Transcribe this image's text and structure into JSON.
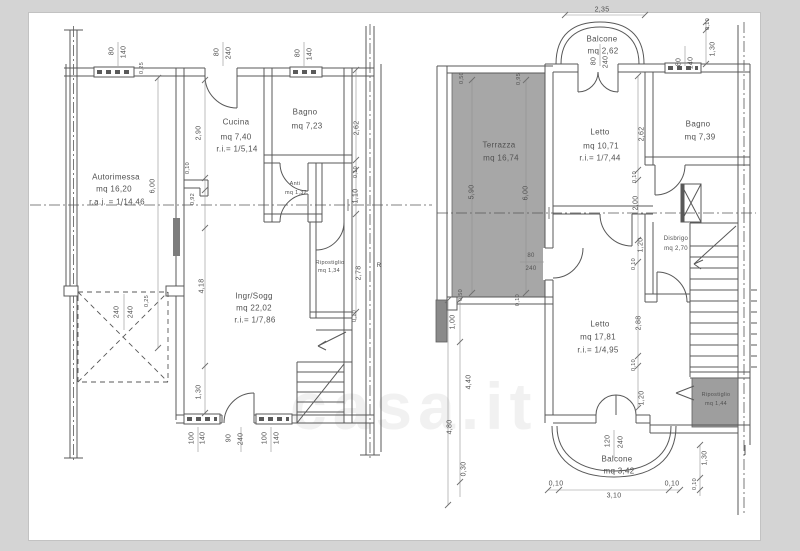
{
  "watermark": "casa.it",
  "ground": {
    "rooms": {
      "autorimessa": {
        "name": "Autorimessa",
        "area": "mq 16,20",
        "ratio": "r.a.i. = 1/14,46"
      },
      "cucina": {
        "name": "Cucina",
        "area": "mq 7,40",
        "ratio": "r.i.= 1/5,14"
      },
      "bagno": {
        "name": "Bagno",
        "area": "mq 7,23"
      },
      "anti": {
        "name": "Anti",
        "area": "mq 1,32"
      },
      "ingresso_soggiorno": {
        "name": "Ingr/Sogg",
        "area": "mq 22,02",
        "ratio": "r.i.= 1/7,86"
      },
      "ripostiglio": {
        "name": "Ripostiglio",
        "area": "mq 1,34"
      },
      "neighbor_partial": "R"
    },
    "dims": {
      "top": [
        "80",
        "140",
        "80",
        "240",
        "80",
        "140",
        "0,25"
      ],
      "left": [
        "2,90",
        "0,10",
        "6,00",
        "0,92",
        "4,18",
        "1,30"
      ],
      "garage": [
        "240",
        "240",
        "0,25"
      ],
      "bottom": [
        "100",
        "140",
        "90",
        "240",
        "100",
        "140"
      ],
      "right": [
        "2,62",
        "0,10",
        "1,10",
        "2,78",
        "0,10"
      ]
    }
  },
  "first": {
    "rooms": {
      "balcone_nord": {
        "name": "Balcone",
        "area": "mq 2,62"
      },
      "terrazza": {
        "name": "Terrazza",
        "area": "mq 16,74"
      },
      "letto_1": {
        "name": "Letto",
        "area": "mq 10,71",
        "ratio": "r.i.= 1/7,44"
      },
      "bagno": {
        "name": "Bagno",
        "area": "mq 7,39"
      },
      "disbrigo": {
        "name": "Disbrigo",
        "area": "mq 2,70"
      },
      "letto_2": {
        "name": "Letto",
        "area": "mq 17,81",
        "ratio": "r.i.= 1/4,95"
      },
      "ripostiglio": {
        "name": "Ripostiglio",
        "area": "mq 1,44"
      },
      "balcone_sud": {
        "name": "Balcone",
        "area": "mq 3,42"
      }
    },
    "dims": {
      "top": [
        "2,35",
        "80",
        "240",
        "80",
        "140",
        "0,10",
        "1,30"
      ],
      "terrazza": [
        "0,50",
        "0,95",
        "5,90",
        "6,00",
        "0,50",
        "0,10"
      ],
      "terrazza_door": [
        "80",
        "240"
      ],
      "inner": [
        "2,62",
        "0,10",
        "2,00",
        "1,20",
        "0,10",
        "2,88",
        "0,10",
        "1,20"
      ],
      "left": [
        "1,00",
        "4,40",
        "4,80",
        "0,30"
      ],
      "bottom": [
        "120",
        "240",
        "0,10",
        "3,10",
        "0,10",
        "1,30",
        "0,10"
      ]
    }
  }
}
